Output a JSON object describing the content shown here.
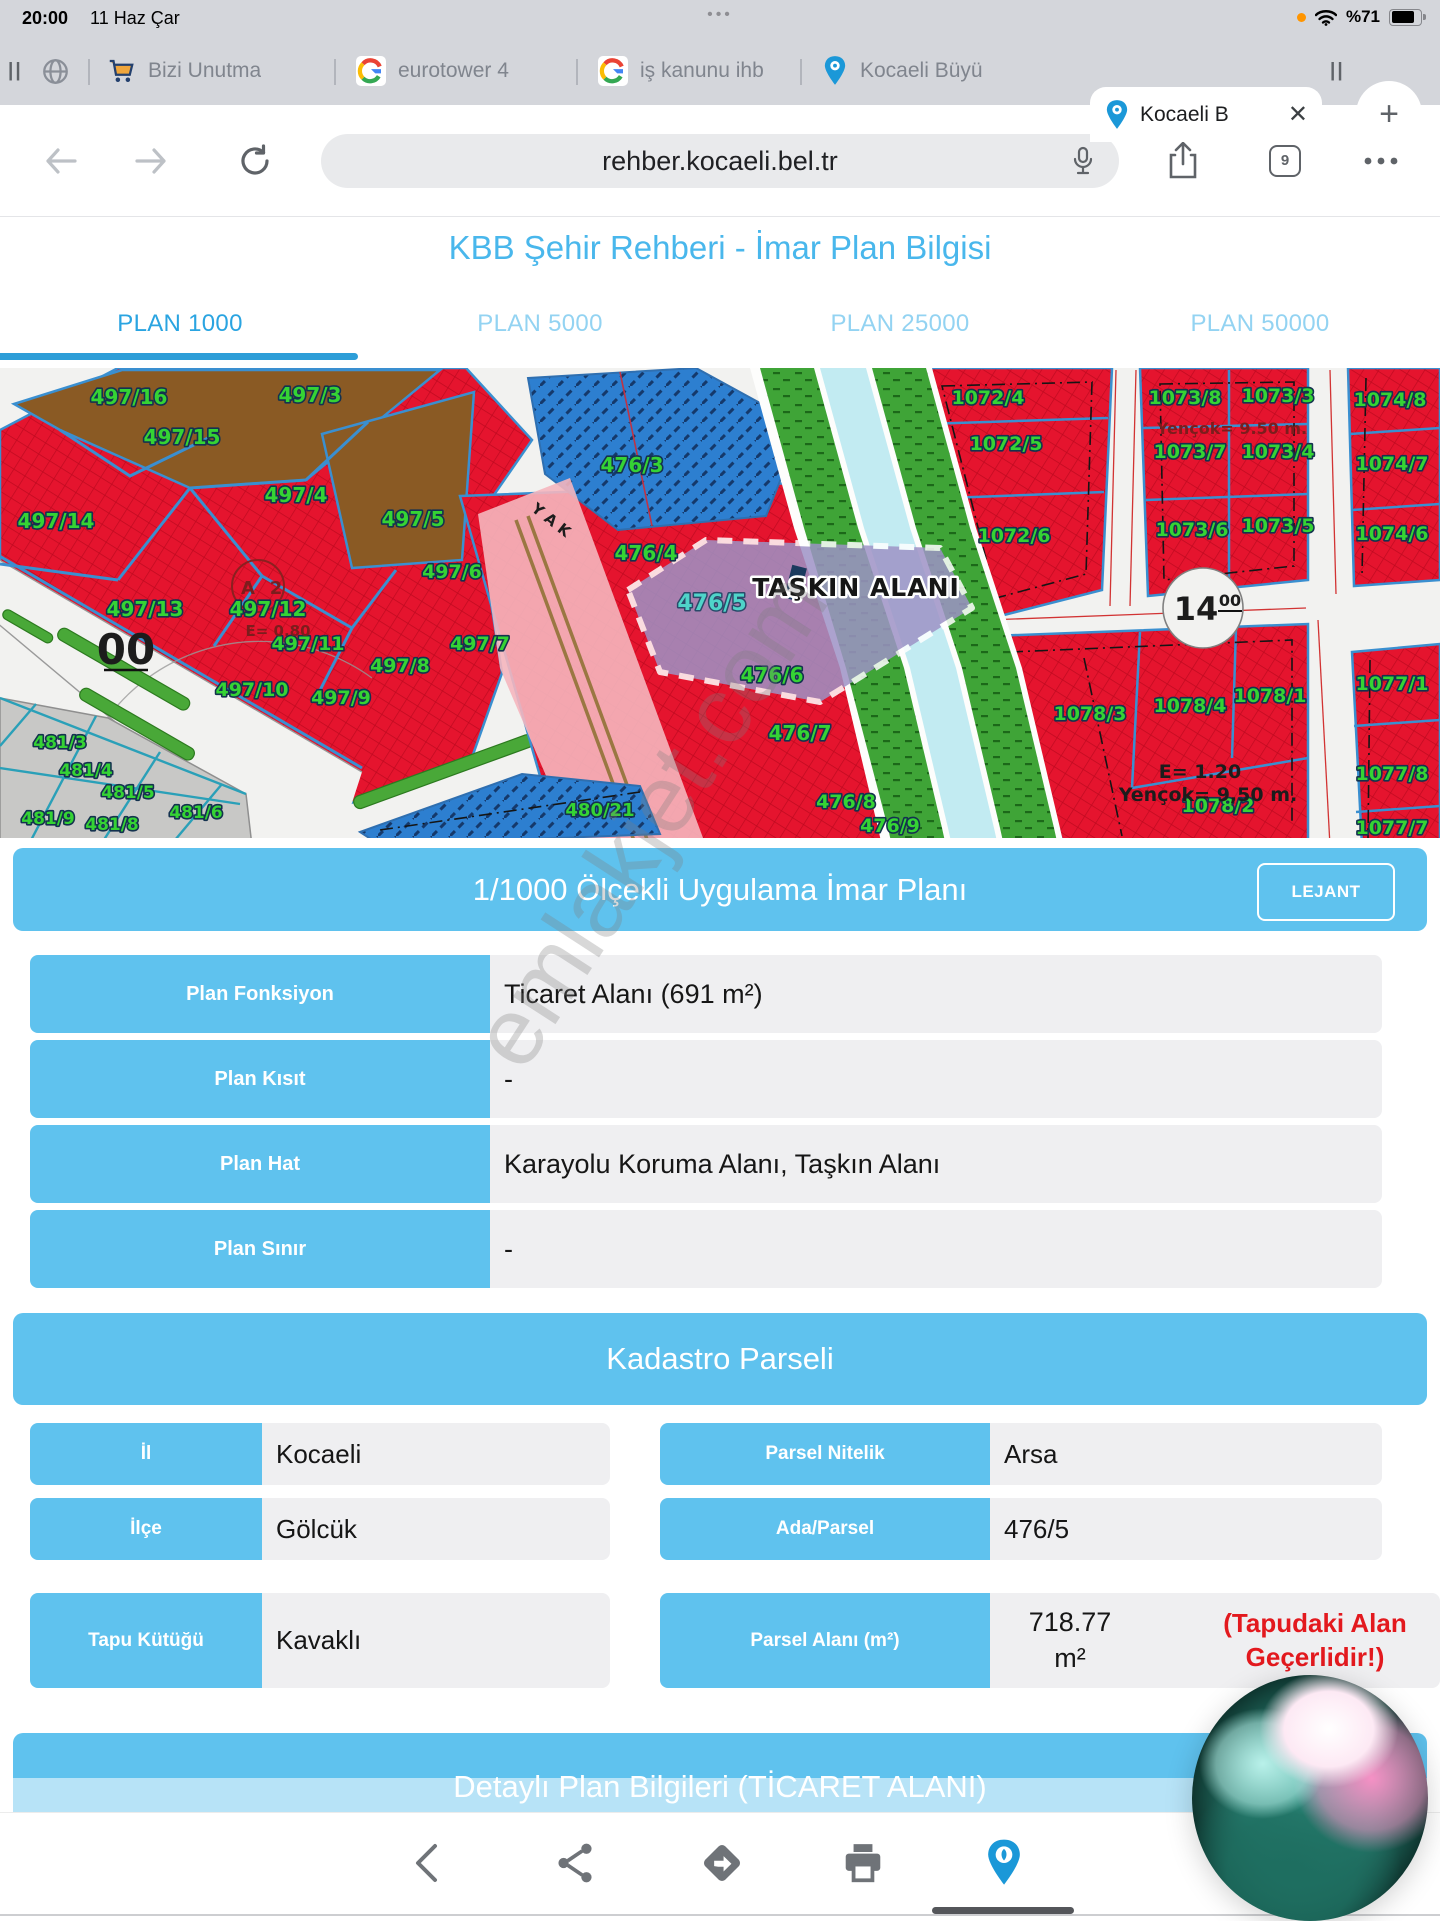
{
  "status_bar": {
    "time": "20:00",
    "date": "11 Haz Çar",
    "center_dots": "•••",
    "battery_percent": "%71"
  },
  "tab_bar": {
    "tabs": [
      {
        "label": "Bizi Unutma"
      },
      {
        "label": "eurotower 4"
      },
      {
        "label": "iş kanunu ihb"
      },
      {
        "label": "Kocaeli Büyü"
      },
      {
        "label": "Kocaeli B"
      }
    ],
    "close_glyph": "✕",
    "new_tab_glyph": "+"
  },
  "nav": {
    "url": "rehber.kocaeli.bel.tr",
    "tab_count": "9"
  },
  "header": {
    "title": "KBB Şehir Rehberi - İmar Plan Bilgisi"
  },
  "plan_tabs": {
    "items": [
      {
        "label": "PLAN 1000"
      },
      {
        "label": "PLAN 5000"
      },
      {
        "label": "PLAN 25000"
      },
      {
        "label": "PLAN 50000"
      }
    ],
    "active": "PLAN 1000"
  },
  "map": {
    "labels": [
      {
        "t": "497/16",
        "x": 129,
        "y": 36,
        "c": "g",
        "s": 20
      },
      {
        "t": "497/3",
        "x": 310,
        "y": 34,
        "c": "g",
        "s": 20
      },
      {
        "t": "497/15",
        "x": 182,
        "y": 76,
        "c": "g",
        "s": 20
      },
      {
        "t": "497/4",
        "x": 296,
        "y": 134,
        "c": "g",
        "s": 20
      },
      {
        "t": "497/5",
        "x": 413,
        "y": 158,
        "c": "g",
        "s": 20
      },
      {
        "t": "497/14",
        "x": 56,
        "y": 160,
        "c": "g",
        "s": 20
      },
      {
        "t": "497/6",
        "x": 452,
        "y": 210,
        "c": "g",
        "s": 19
      },
      {
        "t": "497/13",
        "x": 145,
        "y": 248,
        "c": "g",
        "s": 20
      },
      {
        "t": "497/12",
        "x": 268,
        "y": 248,
        "c": "g",
        "s": 20
      },
      {
        "t": "497/11",
        "x": 308,
        "y": 282,
        "c": "g",
        "s": 19
      },
      {
        "t": "497/7",
        "x": 480,
        "y": 282,
        "c": "g",
        "s": 19
      },
      {
        "t": "497/8",
        "x": 400,
        "y": 304,
        "c": "g",
        "s": 19
      },
      {
        "t": "497/10",
        "x": 252,
        "y": 328,
        "c": "g",
        "s": 19
      },
      {
        "t": "497/9",
        "x": 341,
        "y": 336,
        "c": "g",
        "s": 19
      },
      {
        "t": "481/3",
        "x": 60,
        "y": 380,
        "c": "g",
        "s": 17
      },
      {
        "t": "481/4",
        "x": 86,
        "y": 408,
        "c": "g",
        "s": 17
      },
      {
        "t": "481/5",
        "x": 128,
        "y": 430,
        "c": "g",
        "s": 17
      },
      {
        "t": "481/6",
        "x": 196,
        "y": 450,
        "c": "g",
        "s": 17
      },
      {
        "t": "481/9",
        "x": 48,
        "y": 456,
        "c": "g",
        "s": 17
      },
      {
        "t": "481/8",
        "x": 112,
        "y": 462,
        "c": "g",
        "s": 17
      },
      {
        "t": "476/3",
        "x": 632,
        "y": 104,
        "c": "g",
        "s": 20
      },
      {
        "t": "476/4",
        "x": 646,
        "y": 192,
        "c": "g",
        "s": 20
      },
      {
        "t": "476/5",
        "x": 712,
        "y": 242,
        "c": "t",
        "s": 22
      },
      {
        "t": "476/6",
        "x": 772,
        "y": 314,
        "c": "g",
        "s": 20
      },
      {
        "t": "476/7",
        "x": 800,
        "y": 372,
        "c": "g",
        "s": 20
      },
      {
        "t": "476/8",
        "x": 846,
        "y": 440,
        "c": "g",
        "s": 19
      },
      {
        "t": "476/9",
        "x": 890,
        "y": 464,
        "c": "g",
        "s": 19
      },
      {
        "t": "480/21",
        "x": 600,
        "y": 448,
        "c": "g",
        "s": 18
      },
      {
        "t": "1072/4",
        "x": 988,
        "y": 36,
        "c": "g",
        "s": 19
      },
      {
        "t": "1072/5",
        "x": 1006,
        "y": 82,
        "c": "g",
        "s": 19
      },
      {
        "t": "1072/6",
        "x": 1014,
        "y": 174,
        "c": "g",
        "s": 19
      },
      {
        "t": "1073/8",
        "x": 1185,
        "y": 36,
        "c": "g",
        "s": 19
      },
      {
        "t": "1073/3",
        "x": 1278,
        "y": 34,
        "c": "g",
        "s": 19
      },
      {
        "t": "1073/7",
        "x": 1190,
        "y": 90,
        "c": "g",
        "s": 19
      },
      {
        "t": "1073/4",
        "x": 1278,
        "y": 90,
        "c": "g",
        "s": 19
      },
      {
        "t": "1073/6",
        "x": 1192,
        "y": 168,
        "c": "g",
        "s": 19
      },
      {
        "t": "1073/5",
        "x": 1278,
        "y": 164,
        "c": "g",
        "s": 19
      },
      {
        "t": "1074/8",
        "x": 1390,
        "y": 38,
        "c": "g",
        "s": 19
      },
      {
        "t": "1074/7",
        "x": 1392,
        "y": 102,
        "c": "g",
        "s": 19
      },
      {
        "t": "1074/6",
        "x": 1392,
        "y": 172,
        "c": "g",
        "s": 19
      },
      {
        "t": "1078/3",
        "x": 1090,
        "y": 352,
        "c": "g",
        "s": 19
      },
      {
        "t": "1078/4",
        "x": 1190,
        "y": 344,
        "c": "g",
        "s": 19
      },
      {
        "t": "1078/1",
        "x": 1270,
        "y": 334,
        "c": "g",
        "s": 19
      },
      {
        "t": "1078/2",
        "x": 1218,
        "y": 444,
        "c": "g",
        "s": 19
      },
      {
        "t": "1077/1",
        "x": 1392,
        "y": 322,
        "c": "g",
        "s": 19
      },
      {
        "t": "1077/8",
        "x": 1392,
        "y": 412,
        "c": "g",
        "s": 19
      },
      {
        "t": "1077/7",
        "x": 1392,
        "y": 466,
        "c": "g",
        "s": 19
      },
      {
        "t": "TAŞKIN ALANI",
        "x": 856,
        "y": 228,
        "c": "k",
        "s": 25
      },
      {
        "t": "Yençok= 9.50 m.",
        "x": 1232,
        "y": 66,
        "c": "r",
        "s": 16
      },
      {
        "t": "E= 0.80",
        "x": 278,
        "y": 268,
        "c": "r",
        "s": 15
      },
      {
        "t": "E= 1.20",
        "x": 1200,
        "y": 410,
        "c": "kp",
        "s": 19
      },
      {
        "t": "Yençok= 9,50 m.",
        "x": 1208,
        "y": 433,
        "c": "kp",
        "s": 19
      },
      {
        "t": "00",
        "x": 126,
        "y": 296,
        "c": "kp",
        "s": 42
      },
      {
        "t": "14",
        "x": 1196,
        "y": 252,
        "c": "kp",
        "s": 32
      },
      {
        "t": "00",
        "x": 1230,
        "y": 238,
        "c": "kp",
        "s": 16
      },
      {
        "t": "Y A K",
        "x": 548,
        "y": 156,
        "c": "kp",
        "s": 15,
        "rot": 38
      },
      {
        "t": "A",
        "x": 248,
        "y": 226,
        "c": "r",
        "s": 18
      },
      {
        "t": "2",
        "x": 276,
        "y": 226,
        "c": "r",
        "s": 18
      }
    ]
  },
  "plan_info": {
    "banner": "1/1000 Ölçekli Uygulama İmar Planı",
    "legend_button": "LEJANT",
    "rows": [
      {
        "label": "Plan Fonksiyon",
        "value": "Ticaret Alanı (691 m²)"
      },
      {
        "label": "Plan Kısıt",
        "value": "-"
      },
      {
        "label": "Plan Hat",
        "value": "Karayolu Koruma Alanı, Taşkın Alanı"
      },
      {
        "label": "Plan Sınır",
        "value": "-"
      }
    ]
  },
  "kadastro": {
    "banner": "Kadastro Parseli",
    "left_rows": [
      {
        "label": "İl",
        "value": "Kocaeli"
      },
      {
        "label": "İlçe",
        "value": "Gölcük"
      },
      {
        "label": "Tapu Kütüğü",
        "value": "Kavaklı"
      }
    ],
    "right_rows": [
      {
        "label": "Parsel Nitelik",
        "value": "Arsa"
      },
      {
        "label": "Ada/Parsel",
        "value": "476/5"
      }
    ],
    "area_row": {
      "label": "Parsel Alanı (m²)",
      "value": "718.77",
      "unit": "m²",
      "note": "(Tapudaki Alan Geçerlidir!)"
    }
  },
  "detail": {
    "banner": "Detaylı Plan Bilgileri (TİCARET ALANI)"
  },
  "watermark": "emlakjet.com",
  "toolbar": {
    "icons": [
      "chevron-back",
      "share",
      "directions",
      "print",
      "kbb-logo"
    ]
  }
}
